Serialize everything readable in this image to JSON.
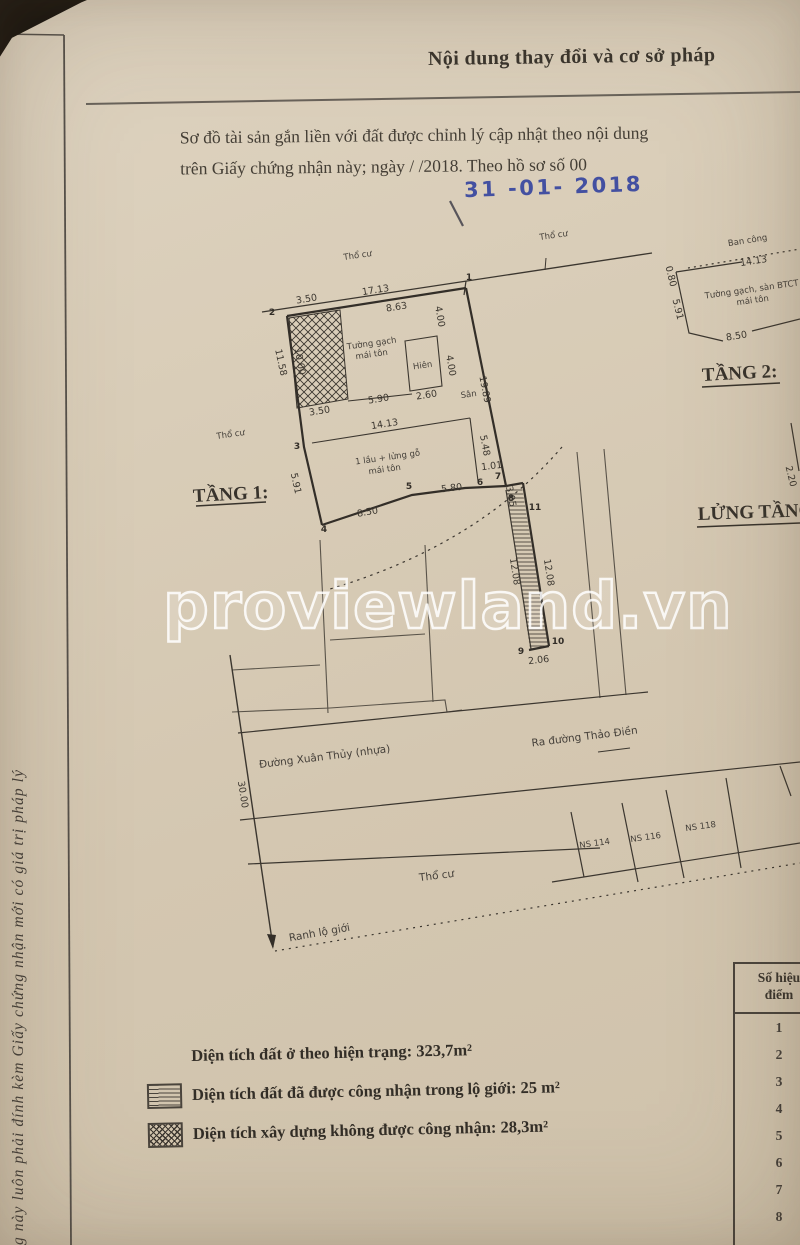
{
  "colors": {
    "paper": "#d6cab6",
    "ink": "#3b362f",
    "stamp_blue": "#2f3f9e",
    "watermark": "#ffffff"
  },
  "header": {
    "title": "Nội dung thay đổi và cơ sở pháp"
  },
  "body_text": {
    "line1": "Sơ đồ tài sản gắn liền với đất được chỉnh lý cập nhật theo nội dung",
    "line2": "trên Giấy chứng nhận này; ngày      /      /2018. Theo hồ sơ số 00",
    "stamp_date": "31 -01- 2018"
  },
  "watermark": "proviewland.vn",
  "side_note": "g này luôn phải đính kèm Giấy chứng nhận mới có giá trị pháp lý",
  "plan": {
    "texts": {
      "tho_cu_top": "Thổ cư",
      "tho_cu_mid": "Thổ cư",
      "tho_cu_left": "Thổ cư",
      "tho_cu_bottom": "Thổ cư",
      "pt1": "1",
      "pt2": "2",
      "pt3": "3",
      "pt4": "4",
      "pt5": "5",
      "pt6": "6",
      "pt7": "7",
      "pt8": "8",
      "pt9": "9",
      "pt10": "10",
      "pt11": "11",
      "d_350_top": "3.50",
      "d_1713": "17.13",
      "d_863": "8.63",
      "d_400_a": "4.00",
      "d_1000": "10.00",
      "d_1158": "11.58",
      "d_350_bot": "3.50",
      "d_590": "5.90",
      "d_1413": "14.13",
      "d_260": "2.60",
      "d_400_b": "4.00",
      "d_1989": "19.89",
      "d_591": "5.91",
      "d_850": "8.50",
      "d_580": "5.80",
      "d_101": "1.01",
      "d_548": "5.48",
      "d_305": "3.05",
      "d_1208_l": "12.08",
      "d_1208_r": "12.08",
      "d_206": "2.06",
      "d_3000": "30.00",
      "wall1a": "Tường gạch",
      "wall1b": "mái tôn",
      "hien": "Hiên",
      "san": "Sân",
      "house1": "1 lầu + lửng gỗ",
      "house2": "mái tôn",
      "tang1": "TẦNG 1:",
      "road": "Đường Xuân Thủy (nhựa)",
      "ra_duong": "Ra đường Thảo Điền",
      "ns114": "NS 114",
      "ns116": "NS 116",
      "ns118": "NS 118",
      "ranh": "Ranh lộ giới",
      "ban_cong": "Ban công",
      "d2_1413": "14.13",
      "wall2a": "Tường gạch, sàn BTCT",
      "wall2b": "mái tôn",
      "d2_080": "0.80",
      "d2_591": "5.91",
      "d2_850": "8.50",
      "tang2": "TẦNG 2:",
      "d2_220": "2.20",
      "lung": "LỬNG TẦNG"
    }
  },
  "legend": {
    "items": [
      {
        "swatch": "none",
        "text": "Diện tích đất ở theo hiện trạng: 323,7m²"
      },
      {
        "swatch": "hstripes",
        "text": "Diện tích đất đã được công nhận trong lộ giới: 25 m²"
      },
      {
        "swatch": "crosshatch",
        "text": "Diện tích xây dựng không được công nhận: 28,3m²"
      }
    ]
  },
  "point_table": {
    "header_line1": "Số hiệu",
    "header_line2": "điểm",
    "rows": [
      "1",
      "2",
      "3",
      "4",
      "5",
      "6",
      "7",
      "8"
    ]
  }
}
